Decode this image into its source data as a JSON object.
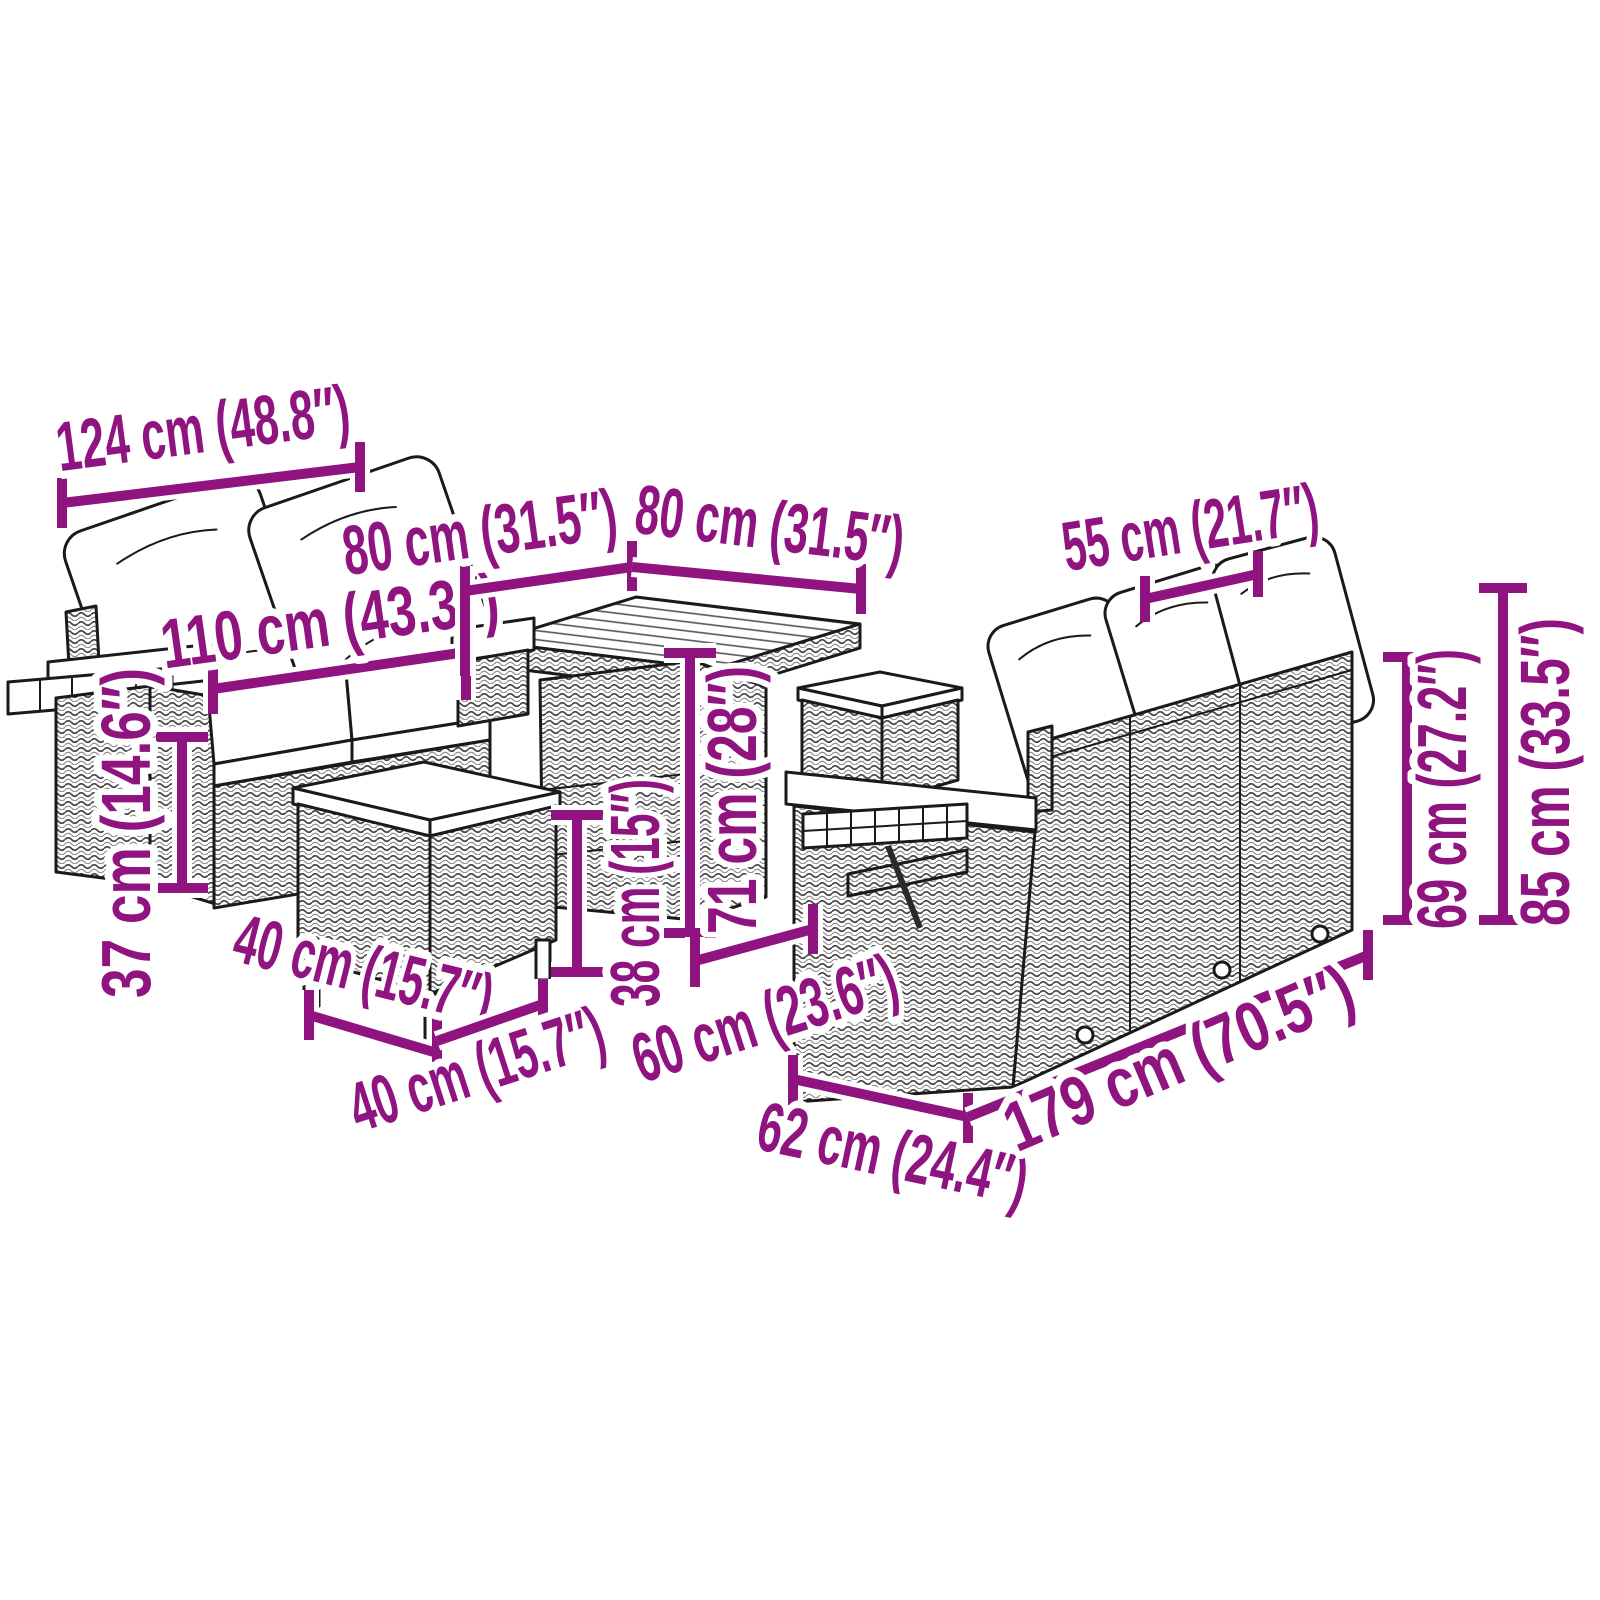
{
  "colors": {
    "accent": "#8F1480",
    "line_art": "#1a1a1a",
    "background": "#ffffff"
  },
  "dims": [
    {
      "id": "left-sofa-total-width",
      "label": "124 cm (48.8″)"
    },
    {
      "id": "left-sofa-seat-width",
      "label": "110 cm (43.3″)"
    },
    {
      "id": "table-width",
      "label": "80 cm (31.5″)"
    },
    {
      "id": "table-depth",
      "label": "80 cm (31.5″)"
    },
    {
      "id": "cushion-width",
      "label": "55 cm (21.7″)"
    },
    {
      "id": "seat-height",
      "label": "37 cm (14.6″)"
    },
    {
      "id": "stool-height",
      "label": "38 cm (15″)"
    },
    {
      "id": "table-height",
      "label": "71 cm (28″)"
    },
    {
      "id": "stool-width",
      "label": "40 cm (15.7″)"
    },
    {
      "id": "stool-depth",
      "label": "40 cm (15.7″)"
    },
    {
      "id": "sofa-seat-depth",
      "label": "60 cm (23.6″)"
    },
    {
      "id": "sofa-depth",
      "label": "62 cm (24.4″)"
    },
    {
      "id": "sofa-length",
      "label": "179 cm (70.5″)"
    },
    {
      "id": "back-height",
      "label": "69 cm (27.2″)"
    },
    {
      "id": "total-height",
      "label": "85 cm (33.5″)"
    }
  ]
}
